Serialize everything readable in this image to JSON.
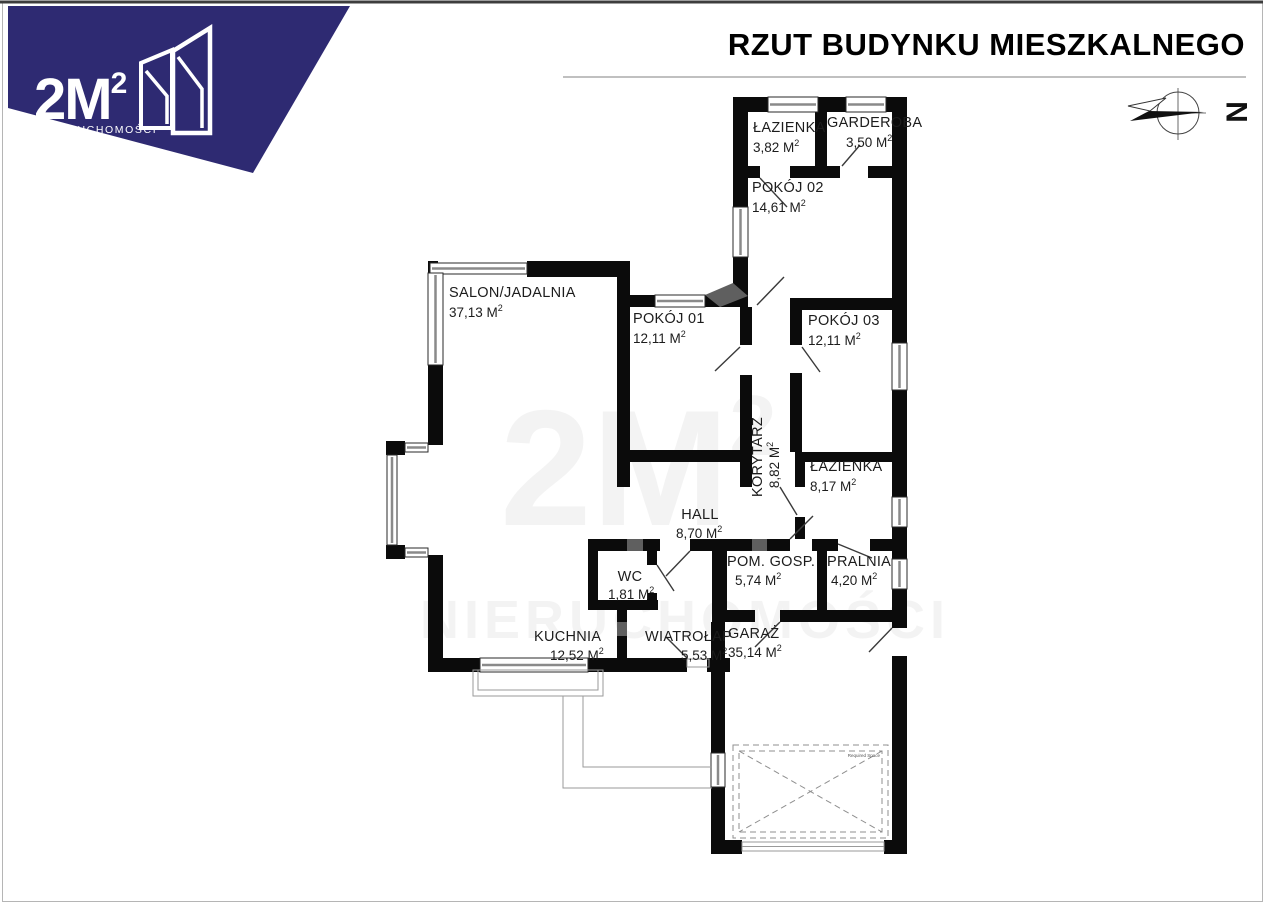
{
  "header": {
    "title": "RZUT BUDYNKU MIESZKALNEGO"
  },
  "logo": {
    "brand": "2M",
    "brand_sup": "2",
    "subtitle": "NIERUCHOMOŚCI",
    "navy": "#2e2a72"
  },
  "compass": {
    "letter": "N"
  },
  "plan": {
    "sup": "2",
    "required_space_label": "Required Space",
    "rooms": [
      {
        "name": "ŁAZIENKA",
        "area": "3,82 M"
      },
      {
        "name": "GARDEROBA",
        "area": "3,50 M"
      },
      {
        "name": "POKÓJ 02",
        "area": "14,61 M"
      },
      {
        "name": "SALON/JADALNIA",
        "area": "37,13 M"
      },
      {
        "name": "POKÓJ 01",
        "area": "12,11 M"
      },
      {
        "name": "POKÓJ 03",
        "area": "12,11 M"
      },
      {
        "name": "KORYTARZ",
        "area": "8,82 M"
      },
      {
        "name": "ŁAZIENKA",
        "area": "8,17 M"
      },
      {
        "name": "HALL",
        "area": "8,70 M"
      },
      {
        "name": "WC",
        "area": "1,81 M"
      },
      {
        "name": "POM. GOSP.",
        "area": "5,74 M"
      },
      {
        "name": "PRALNIA",
        "area": "4,20 M"
      },
      {
        "name": "KUCHNIA",
        "area": "12,52 M"
      },
      {
        "name": "WIATROŁAP",
        "area": "5,53 M"
      },
      {
        "name": "GARAŻ",
        "area": "35,14 M"
      }
    ]
  }
}
